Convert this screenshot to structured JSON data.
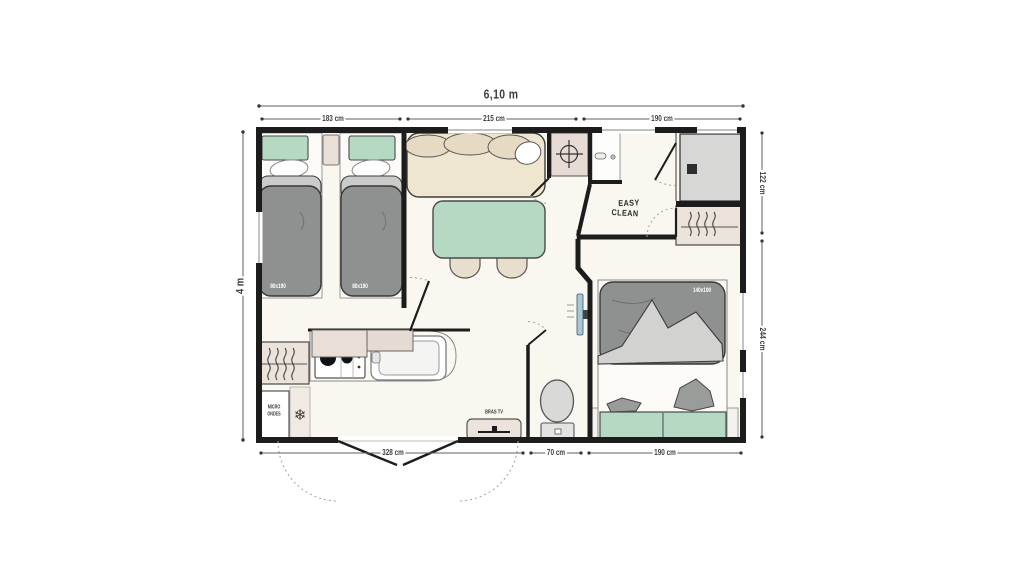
{
  "plan": {
    "name": "mobile-home-floor-plan",
    "total_width_label": "6,10 m",
    "total_height_label": "4 m",
    "dim_top": [
      "183 cm",
      "215 cm",
      "190 cm"
    ],
    "dim_right": [
      "122 cm",
      "244 cm"
    ],
    "dim_bottom": [
      "328 cm",
      "70 cm",
      "190 cm"
    ],
    "beds": {
      "single_left_label": "80x190",
      "single_right_label": "80x190",
      "double_label": "140x190"
    },
    "kitchen": {
      "microwave_line1": "MICRO",
      "microwave_line2": "ONDES"
    },
    "living": {
      "tv_label": "BRAS TV"
    },
    "bathroom": {
      "logo_line1": "EASY",
      "logo_line2": "CLEAN"
    },
    "icons": {
      "snowflake": "❄"
    },
    "colors": {
      "wall": "#1c1c1c",
      "floor": "#faf7f0",
      "accent_green": "#b5d9c3",
      "sofa_beige": "#efe6d0",
      "duvet_gray": "#8f9190",
      "blanket_gray": "#d2d2d0",
      "cabinet_beige": "#ece3da",
      "shower_gray": "#d7d7d5",
      "tv_blue": "#a9c8d6"
    }
  }
}
